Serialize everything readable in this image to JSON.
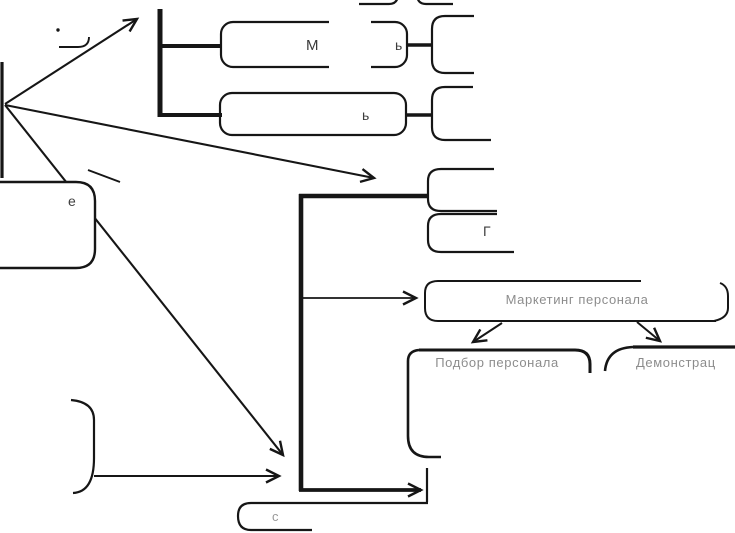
{
  "colors": {
    "ink": "#161616",
    "background": "#ffffff"
  },
  "diagram": {
    "top_tree": {
      "box1_fragment_left": "М",
      "box1_fragment_right": "ь",
      "box2_fragment": "ь"
    },
    "left_node_fragment": "е",
    "stacked_node_fragment": "Г",
    "marketing_label": "Маркетинг персонала",
    "selection_label": "Подбор персонала",
    "demonstration_label": "Демонстрац",
    "bottom_node_fragment": "с"
  }
}
